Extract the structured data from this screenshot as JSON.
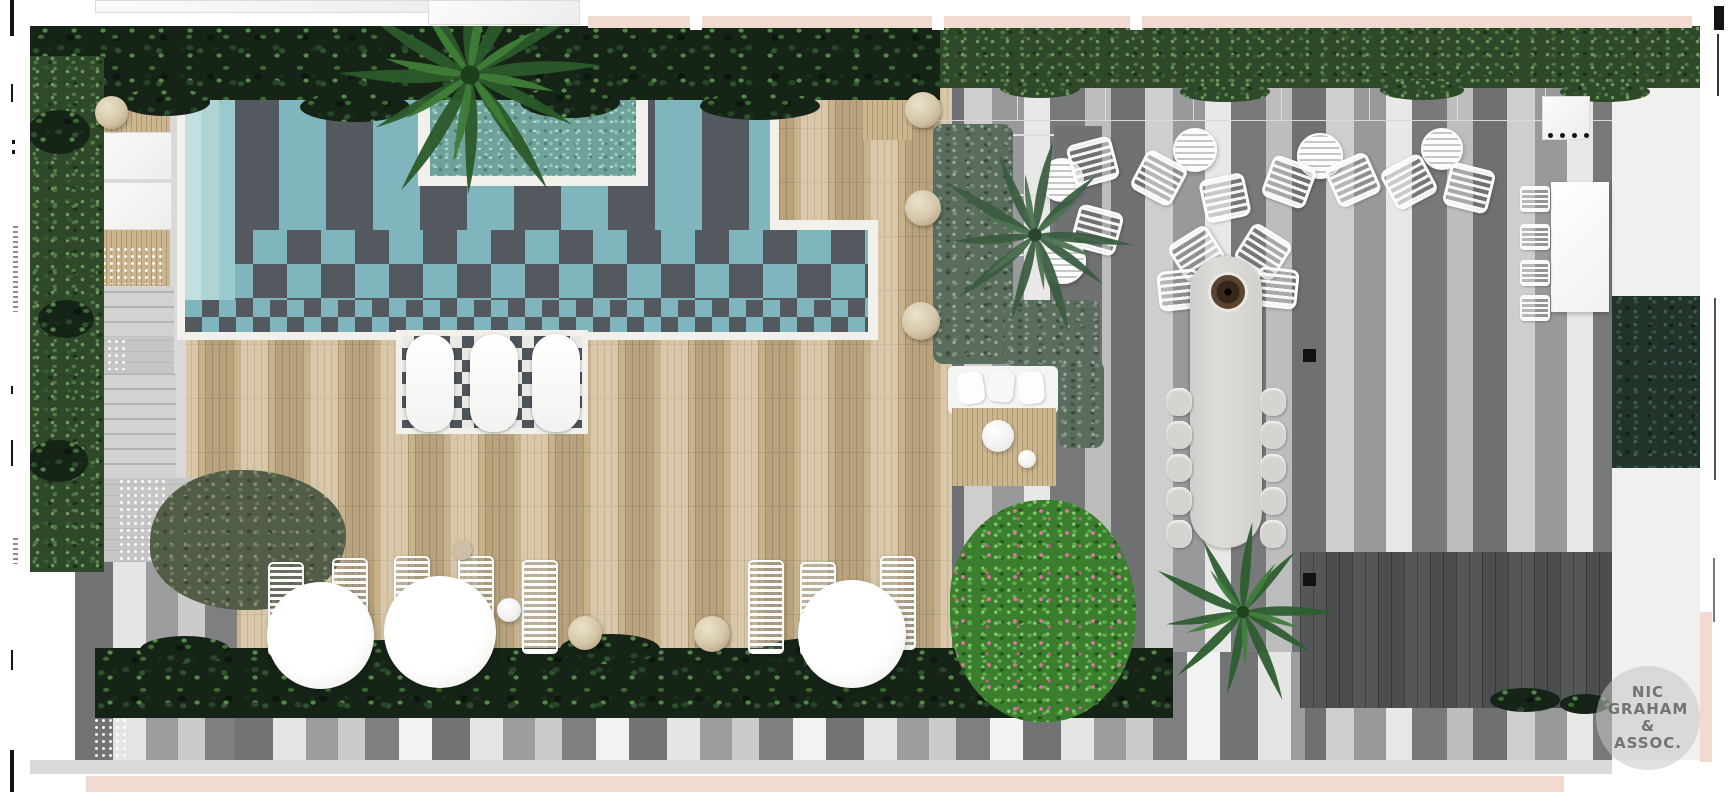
{
  "watermark": {
    "lines": [
      "NIC",
      "GRAHAM",
      "&",
      "ASSOC."
    ]
  },
  "colors": {
    "pool-teal": "#7fb6bd",
    "pool-charcoal": "#53595f",
    "wood": "#c7b28c",
    "dark-deck": "#4b4d4f",
    "hedge-dark": "#162417",
    "sage": "#5a6c5d",
    "flower-green": "#3a7e2e",
    "flower-pink": "#dd74a6",
    "gray-furniture": "#d5d4d1",
    "cream": "#f1dbd1",
    "watermark-circle": "rgba(199,199,199,0.55)",
    "watermark-text": "rgba(100,100,100,0.88)"
  },
  "scene": {
    "description-labels": {
      "pool": "checker-tile-pool",
      "deck": "timber-pool-deck",
      "terrace": "striped-paver-terrace",
      "dining": "long-outdoor-dining-table"
    }
  }
}
